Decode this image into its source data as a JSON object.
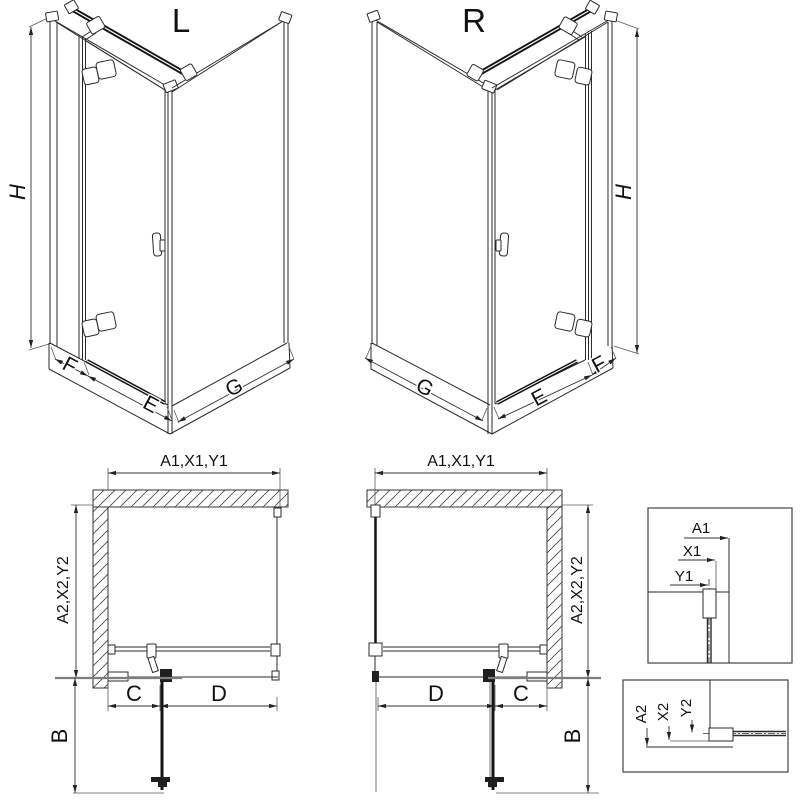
{
  "drawing": {
    "iso_left": {
      "label": "L",
      "dim_height": "H",
      "dim_fixed": "F",
      "dim_door": "E",
      "dim_side": "G"
    },
    "iso_right": {
      "label": "R",
      "dim_height": "H",
      "dim_fixed": "F",
      "dim_door": "E",
      "dim_side": "G"
    },
    "plan_left": {
      "dim_top": "A1,X1,Y1",
      "dim_side": "A2,X2,Y2",
      "dim_c": "C",
      "dim_d": "D",
      "dim_b": "B"
    },
    "plan_right": {
      "dim_top": "A1,X1,Y1",
      "dim_side": "A2,X2,Y2",
      "dim_c": "C",
      "dim_d": "D",
      "dim_b": "B"
    },
    "detail_top": {
      "dim_a": "A1",
      "dim_x": "X1",
      "dim_y": "Y1"
    },
    "detail_bottom": {
      "dim_a": "A2",
      "dim_x": "X2",
      "dim_y": "Y2"
    }
  },
  "colors": {
    "line": "#2b2b2b",
    "thick": "#141414",
    "gray_extension": "#7d7d7d",
    "background": "#ffffff"
  }
}
